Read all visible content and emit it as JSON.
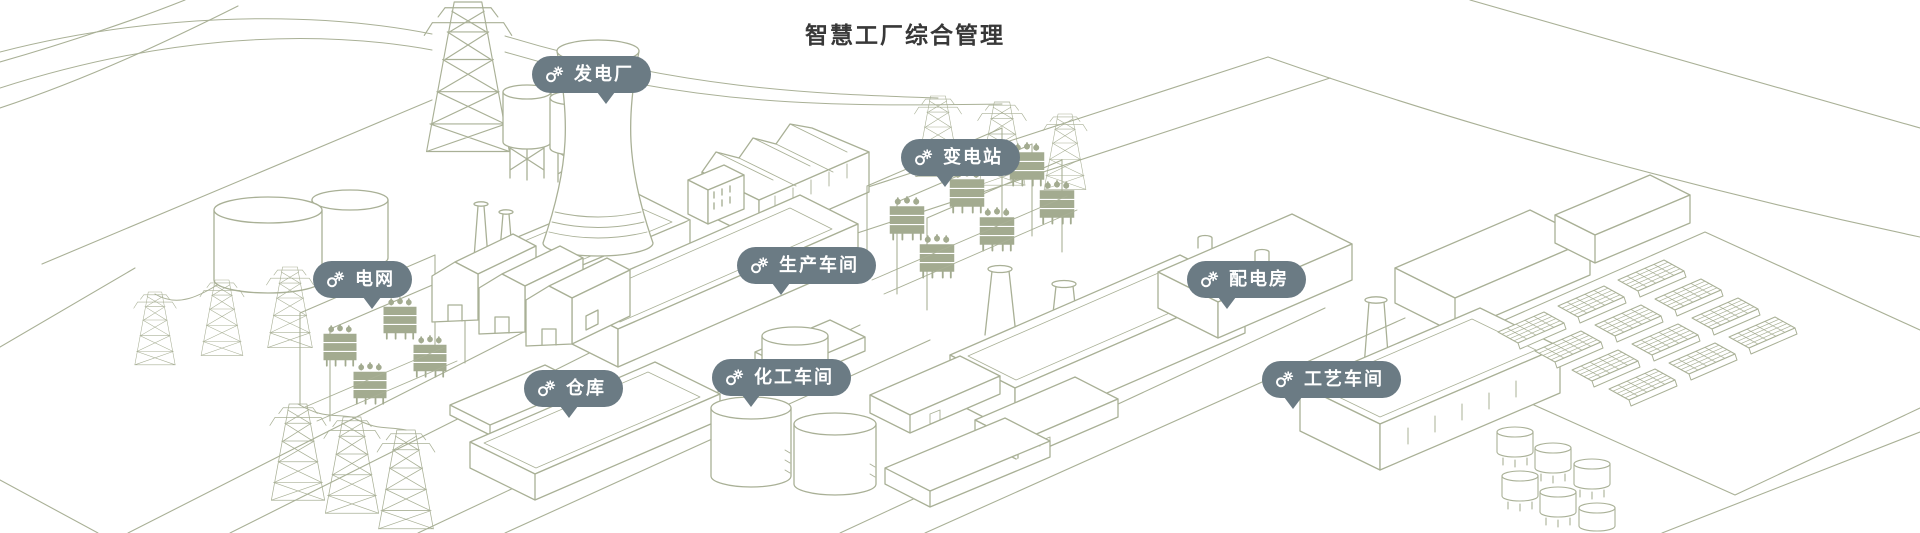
{
  "title": "智慧工厂综合管理",
  "theme": {
    "background": "#ffffff",
    "line_art_color": "#a9b096",
    "line_art_fill": "#a3ab90",
    "badge_background": "#6b7b84",
    "badge_text_color": "#ffffff",
    "title_color": "#383838"
  },
  "badges": [
    {
      "id": "power-plant",
      "label": "发电厂",
      "icon": "gear-icon"
    },
    {
      "id": "substation",
      "label": "变电站",
      "icon": "gear-icon"
    },
    {
      "id": "power-grid",
      "label": "电网",
      "icon": "gear-icon"
    },
    {
      "id": "production-workshop",
      "label": "生产车间",
      "icon": "gear-icon"
    },
    {
      "id": "distribution-room",
      "label": "配电房",
      "icon": "gear-icon"
    },
    {
      "id": "warehouse",
      "label": "仓库",
      "icon": "gear-icon"
    },
    {
      "id": "chemical-workshop",
      "label": "化工车间",
      "icon": "gear-icon"
    },
    {
      "id": "process-workshop",
      "label": "工艺车间",
      "icon": "gear-icon"
    }
  ]
}
